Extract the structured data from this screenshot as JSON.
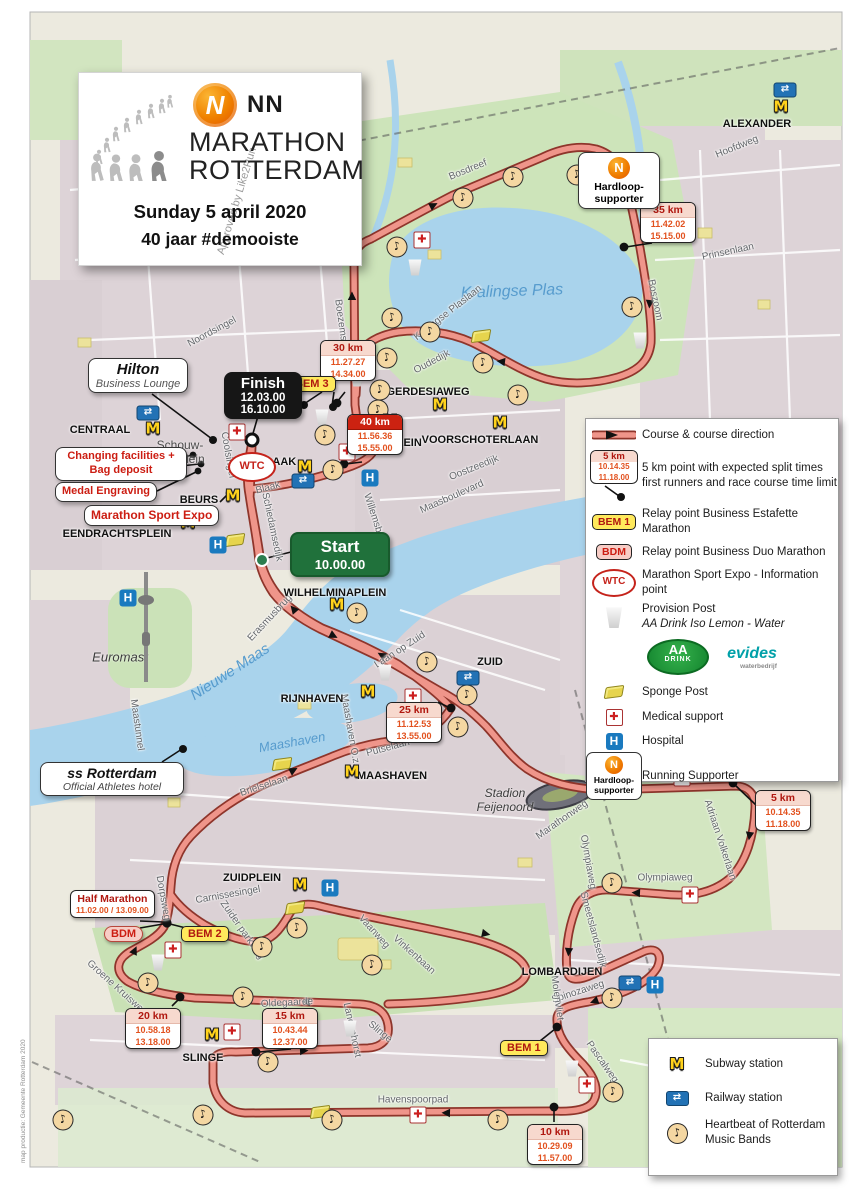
{
  "header": {
    "approved_by": "Approved by Like2Run",
    "brand": "NN",
    "title_line1": "MARATHON",
    "title_line2": "ROTTERDAM",
    "date": "Sunday 5 april 2020",
    "tagline": "40 jaar #demooiste",
    "logo_letter": "N"
  },
  "start": {
    "label": "Start",
    "time": "10.00.00"
  },
  "finish": {
    "label": "Finish",
    "time1": "12.03.00",
    "time2": "16.10.00"
  },
  "km": {
    "k5": {
      "label": "5 km",
      "t1": "10.14.35",
      "t2": "11.18.00"
    },
    "k10": {
      "label": "10 km",
      "t1": "10.29.09",
      "t2": "11.57.00"
    },
    "k15": {
      "label": "15 km",
      "t1": "10.43.44",
      "t2": "12.37.00"
    },
    "k20": {
      "label": "20 km",
      "t1": "10.58.18",
      "t2": "13.18.00"
    },
    "k25": {
      "label": "25 km",
      "t1": "11.12.53",
      "t2": "13.55.00"
    },
    "k30": {
      "label": "30 km",
      "t1": "11.27.27",
      "t2": "14.34.00"
    },
    "k35": {
      "label": "35 km",
      "t1": "11.42.02",
      "t2": "15.15.00"
    },
    "k40": {
      "label": "40 km",
      "t1": "11.56.36",
      "t2": "15.55.00"
    },
    "half": {
      "label": "Half Marathon",
      "times": "11.02.00 / 13.09.00"
    }
  },
  "badges": {
    "bem1": "BEM 1",
    "bem2": "BEM 2",
    "bem3": "BEM 3",
    "bdm": "BDM",
    "wtc": "WTC",
    "hardloop1": "Hardloop-",
    "hardloop2": "supporter"
  },
  "callouts": {
    "hilton1": "Hilton",
    "hilton2": "Business Lounge",
    "changing1": "Changing facilities +",
    "changing2": "Bag deposit",
    "medal": "Medal Engraving",
    "expo": "Marathon Sport Expo",
    "ss1": "ss Rotterdam",
    "ss2": "Official Athletes hotel"
  },
  "stations": {
    "centraal": "CENTRAAL",
    "beurs": "BEURS",
    "eendrachtsplein": "EENDRACHTSPLEIN",
    "blaak": "BLAAK",
    "oostplein": "OOSTPLEIN",
    "gerdesiaweg": "GERDESIAWEG",
    "voorschoterlaan": "VOORSCHOTERLAAN",
    "alexander": "ALEXANDER",
    "wilhelminaplein": "WILHELMINAPLEIN",
    "rijnhaven": "RIJNHAVEN",
    "maashaven": "MAASHAVEN",
    "zuid": "ZUID",
    "zuidplein": "ZUIDPLEIN",
    "slinge": "SLINGE",
    "lombardijen": "LOMBARDIJEN"
  },
  "places": {
    "schouw1": "Schouw-",
    "schouw2": "burgplein",
    "euromast": "Euromast",
    "stadion1": "Stadion",
    "stadion2": "Feijenoord"
  },
  "water": {
    "kralingse": "Kralingse Plas",
    "maas": "Nieuwe Maas",
    "maashaven": "Maashaven"
  },
  "streets": [
    "Bosdreef",
    "Hoofdweg",
    "Prinsenlaan",
    "Boszoom",
    "Kralingse Plaslaan",
    "Boezemstraat",
    "Oudedijk",
    "Noordsingel",
    "Oostzeedijk",
    "Maasboulevard",
    "Willemsbrug",
    "Coolsingel",
    "Schiedamsedijk",
    "Erasmusbrug",
    "Laan op Zuid",
    "Maastunnel",
    "Maashaven O.z.",
    "Putselaan",
    "Brielselaan",
    "Stadionweg",
    "Marathonweg",
    "Olympiaweg",
    "Adriaan Volkerlaan",
    "Vaanweg",
    "Vinkenbaan",
    "Zuider parkweg",
    "Carnissesingel",
    "Groene Kruisweg",
    "Dorpsweg",
    "Oldegaarde",
    "Langenhorst",
    "Slinge",
    "Spinozaweg",
    "Pascalweg",
    "Molenvliet",
    "Havenspoorpad",
    "Smeetslandsedijk",
    "Blaak"
  ],
  "legend": {
    "course": "Course & course direction",
    "km1": "5 km point with expected split times",
    "km2": "first runners and race course time limit",
    "bem": "Relay point Business Estafette Marathon",
    "bdm": "Relay point Business Duo Marathon",
    "wtc": "Marathon Sport Expo - Information point",
    "prov1": "Provision Post",
    "prov2": "AA Drink Iso Lemon - Water",
    "aa_top": "AA",
    "aa_bottom": "DRINK",
    "evides": "evides",
    "evides_sub": "waterbedrijf",
    "sponge": "Sponge Post",
    "medical": "Medical support",
    "hospital": "Hospital",
    "running": "Running Supporter"
  },
  "legend2": {
    "subway": "Subway station",
    "railway": "Railway station",
    "heartbeat1": "Heartbeat of Rotterdam",
    "heartbeat2": "Music Bands"
  },
  "icons": {
    "metro": "M",
    "railway": "⇄",
    "hospital": "H",
    "medical": "✚",
    "music": "♪"
  },
  "credit": "map productie: Gemeente Rotterdam 2020",
  "colors": {
    "course_fill": "#ef958a",
    "course_edge": "#8e352b",
    "metro_yellow": "#ffd21c",
    "rail_blue": "#2272b5",
    "hospital_blue": "#1a7abf",
    "medical_red": "#cc1f1f",
    "start_green": "#20713b",
    "km_red": "#b01810",
    "time_orange": "#e2511e",
    "nn_orange": "#ef7d00",
    "water": "#a9d3ec"
  }
}
